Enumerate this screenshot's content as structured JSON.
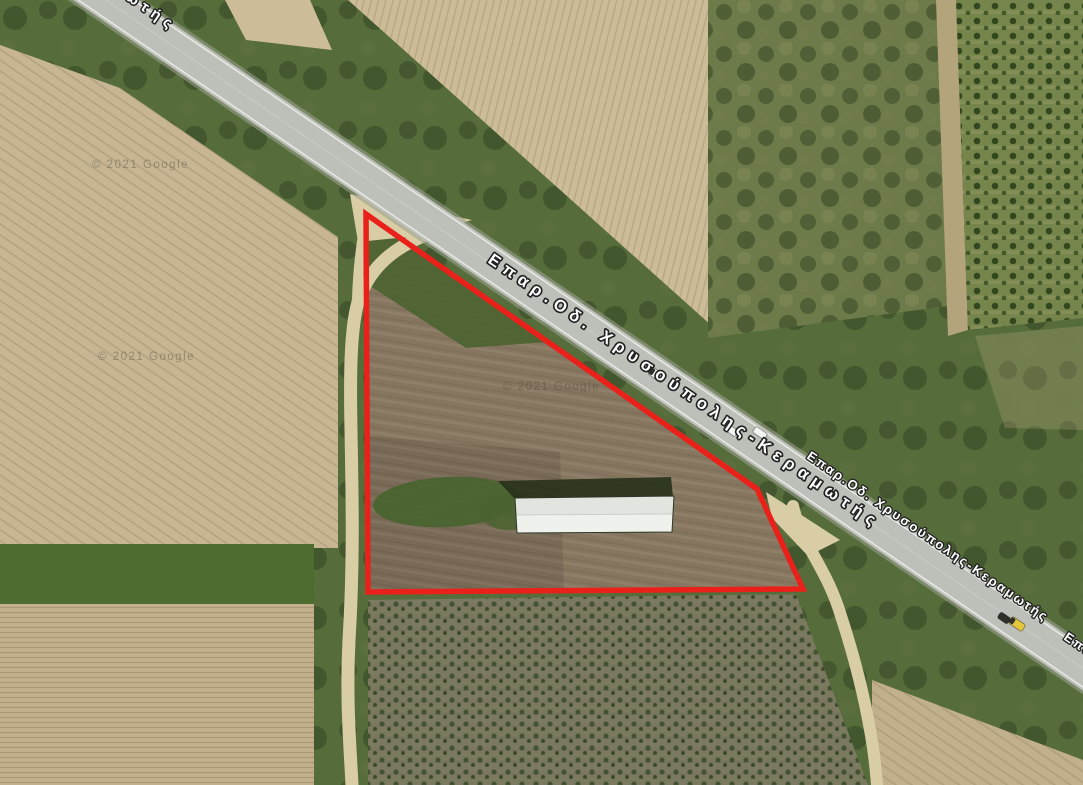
{
  "map": {
    "canvas": {
      "width": 1083,
      "height": 785
    },
    "road_name": "Επαρ.Οδ. Χρυσούπολης-Κεραμωτής",
    "attribution": "© 2021 Google",
    "palette": {
      "scrub": "#566d3b",
      "scrubDark": "#4a6330",
      "tanLight": "#cdbc98",
      "tan": "#c7b593",
      "tan2": "#c2b08c",
      "mottleGreen": "#6d7a49",
      "ditch": "#b4a47c",
      "orchardGreen": "#75854c",
      "hedgerow": "#4e6c30",
      "dirt": "#d9cda6",
      "vineyard": "#7b7a60",
      "parcelSoil": "#867660",
      "shade": "#000000",
      "road": "#bdc0b8",
      "roadCasing": "#9aa08d",
      "roadEdge": "#edefeb",
      "roadCenter": "#d6d8d2",
      "buildingRoof": "#eff1ec",
      "buildingShadow": "#243019",
      "boundaryRed": "#e9211a",
      "labelFill": "#ffffff",
      "labelOutline": "#222222",
      "watermark": "#454034",
      "carWhite": "#f4f5f2",
      "carDark": "#2e2e2a",
      "carYellow": "#e4c63c"
    },
    "regions": [
      {
        "name": "field-small-top",
        "fill": "tanLight",
        "points": "225,0 310,0 332,50 246,40"
      },
      {
        "name": "field-top-plowed",
        "fill": "tanLight",
        "pattern": "stripesTop",
        "points": "348,0 712,0 712,326"
      },
      {
        "name": "field-fallow-green",
        "fill": "mottleGreen",
        "pattern": "mottle",
        "points": "708,0 948,0 948,306 708,338"
      },
      {
        "name": "ditch-strip",
        "fill": "ditch",
        "points": "936,0 956,0 968,330 948,336"
      },
      {
        "name": "field-orchard",
        "fill": "orchardGreen",
        "pattern": "orchard",
        "points": "956,0 1083,0 1083,318 968,330"
      },
      {
        "name": "patch-grass-tan",
        "fill": "ditch",
        "opacity": 0.3,
        "points": "975,336 1083,326 1083,430 1005,428"
      },
      {
        "name": "field-left",
        "fill": "tan",
        "pattern": "stripes34",
        "points": "0,45 120,88 338,237 338,548 0,548"
      },
      {
        "name": "hedgerow-strip",
        "fill": "hedgerow",
        "points": "0,544 314,544 314,604 0,604"
      },
      {
        "name": "field-bottom-left",
        "fill": "tan2",
        "pattern": "stripesH",
        "points": "0,604 314,604 314,785 0,785"
      },
      {
        "name": "field-vineyard",
        "fill": "vineyard",
        "pattern": "vine",
        "points": "368,600 796,594 868,785 368,785"
      },
      {
        "name": "field-bottom-right",
        "fill": "tan2",
        "pattern": "stripes34",
        "points": "872,680 1083,760 1083,785 872,785"
      },
      {
        "name": "parcel-soil",
        "fill": "parcelSoil",
        "pattern": "parcelTex",
        "points": "366,215 757,489 803,589 368,592"
      },
      {
        "name": "parcel-scrub-top",
        "fill": "scrubDark",
        "opacity": 0.9,
        "points": "366,215 548,342 466,348 370,286"
      },
      {
        "name": "parcel-soil-dark",
        "fill": "shade",
        "opacity": 0.1,
        "points": "368,436 560,452 564,592 368,592"
      }
    ],
    "ellipses": [
      {
        "name": "parcel-green-patch",
        "cx": 447,
        "cy": 502,
        "rx": 74,
        "ry": 25,
        "rot": -3,
        "fill": "scrubDark",
        "opacity": 0.95
      },
      {
        "name": "parcel-green-patch-2",
        "cx": 508,
        "cy": 512,
        "rx": 28,
        "ry": 18,
        "rot": 0,
        "fill": "scrubDark",
        "opacity": 0.85
      }
    ],
    "junctions": [
      {
        "name": "track-junction-west",
        "points": "350,194 472,220 416,236 358,242"
      },
      {
        "name": "track-junction-east",
        "points": "766,492 840,540 808,556 772,518"
      }
    ],
    "tracks": [
      {
        "name": "dirt-track-west",
        "d": "M458,224 C408,238 372,258 358,302 C350,330 350,380 351,430 C352,490 354,560 349,640 C346,700 350,745 352,785",
        "width": 13
      },
      {
        "name": "dirt-track-west-branch",
        "d": "M368,208 C362,236 358,264 357,300",
        "width": 10
      },
      {
        "name": "dirt-track-east",
        "d": "M793,506 C802,546 826,566 841,616 C858,668 868,715 873,748 C875,762 876,772 877,785",
        "width": 12
      }
    ],
    "road": {
      "x1": 40,
      "y1": -45,
      "x2": 1100,
      "y2": 680,
      "width": 37,
      "casingWidth": 43,
      "edgeDx": 8.8,
      "edgeDy": -12.8
    },
    "boundary": {
      "points": "366,214 757,489 803,589 368,592",
      "strokeWidth": 5.5
    },
    "building": {
      "shadow": "498,481 671,477 673,497 515,499",
      "roof": "515,498 674,496 672,532 517,533",
      "roofTopHalf": "515,498 674,496 673,514 516,515",
      "ridge": {
        "x1": 516,
        "y1": 515,
        "x2": 673,
        "y2": 514
      }
    },
    "cars": [
      {
        "name": "car-white-1",
        "cx": 657,
        "cy": 375,
        "w": 17,
        "h": 8.5,
        "angle": 34.5,
        "fill": "carWhite",
        "nose": "carDark"
      },
      {
        "name": "car-white-2",
        "cx": 731,
        "cy": 430,
        "w": 14,
        "h": 7,
        "angle": 34.5,
        "fill": "carWhite"
      },
      {
        "name": "car-white-3",
        "cx": 760,
        "cy": 433,
        "w": 14,
        "h": 7,
        "angle": 34.5,
        "fill": "carWhite"
      },
      {
        "name": "car-dark",
        "cx": 1004,
        "cy": 618,
        "w": 12,
        "h": 7,
        "angle": 34.5,
        "fill": "carDark"
      },
      {
        "name": "car-yellow",
        "cx": 1017,
        "cy": 624,
        "w": 16,
        "h": 8,
        "angle": 34.5,
        "fill": "carYellow",
        "nose": "carDark"
      }
    ],
    "labels": [
      {
        "name": "road-label-top-partial",
        "text": "Επαρ.Οδ. Χρυσούπολης-Κεραμωτής",
        "visible_fragment": "ωτής",
        "x": -182,
        "y": -212,
        "angle": 34.5,
        "size": 15,
        "length": 425
      },
      {
        "name": "road-label-main",
        "text": "Επαρ.Οδ. Χρυσούπολης-Κεραμωτής",
        "visible_fragment": "Επαρ.Οδ. Χρυσούπολης-Κεραμωτής",
        "x": 487,
        "y": 262,
        "angle": 34.5,
        "size": 16.5,
        "length": 466
      },
      {
        "name": "road-label-right",
        "text": "Επαρ.Οδ. Χρυσούπολης-Κεραμωτής",
        "visible_fragment": "Επαρ.Οδ. Χρυσούπολης-Κεραμωτής",
        "x": 806,
        "y": 458,
        "angle": 34.5,
        "size": 13,
        "length": 288
      },
      {
        "name": "road-label-corner-partial",
        "text": "Επαρ.Οδ. Χρυσούπολης-Κεραμωτής",
        "visible_fragment": "Επ",
        "x": 1063,
        "y": 639,
        "angle": 34.5,
        "size": 13,
        "length": 288
      }
    ],
    "watermarks": [
      {
        "name": "google-watermark-1",
        "text": "© 2021 Google",
        "x": 92,
        "y": 168
      },
      {
        "name": "google-watermark-2",
        "text": "© 2021 Google",
        "x": 98,
        "y": 360
      },
      {
        "name": "google-watermark-3",
        "text": "© 2021 Google",
        "x": 503,
        "y": 390
      }
    ]
  }
}
